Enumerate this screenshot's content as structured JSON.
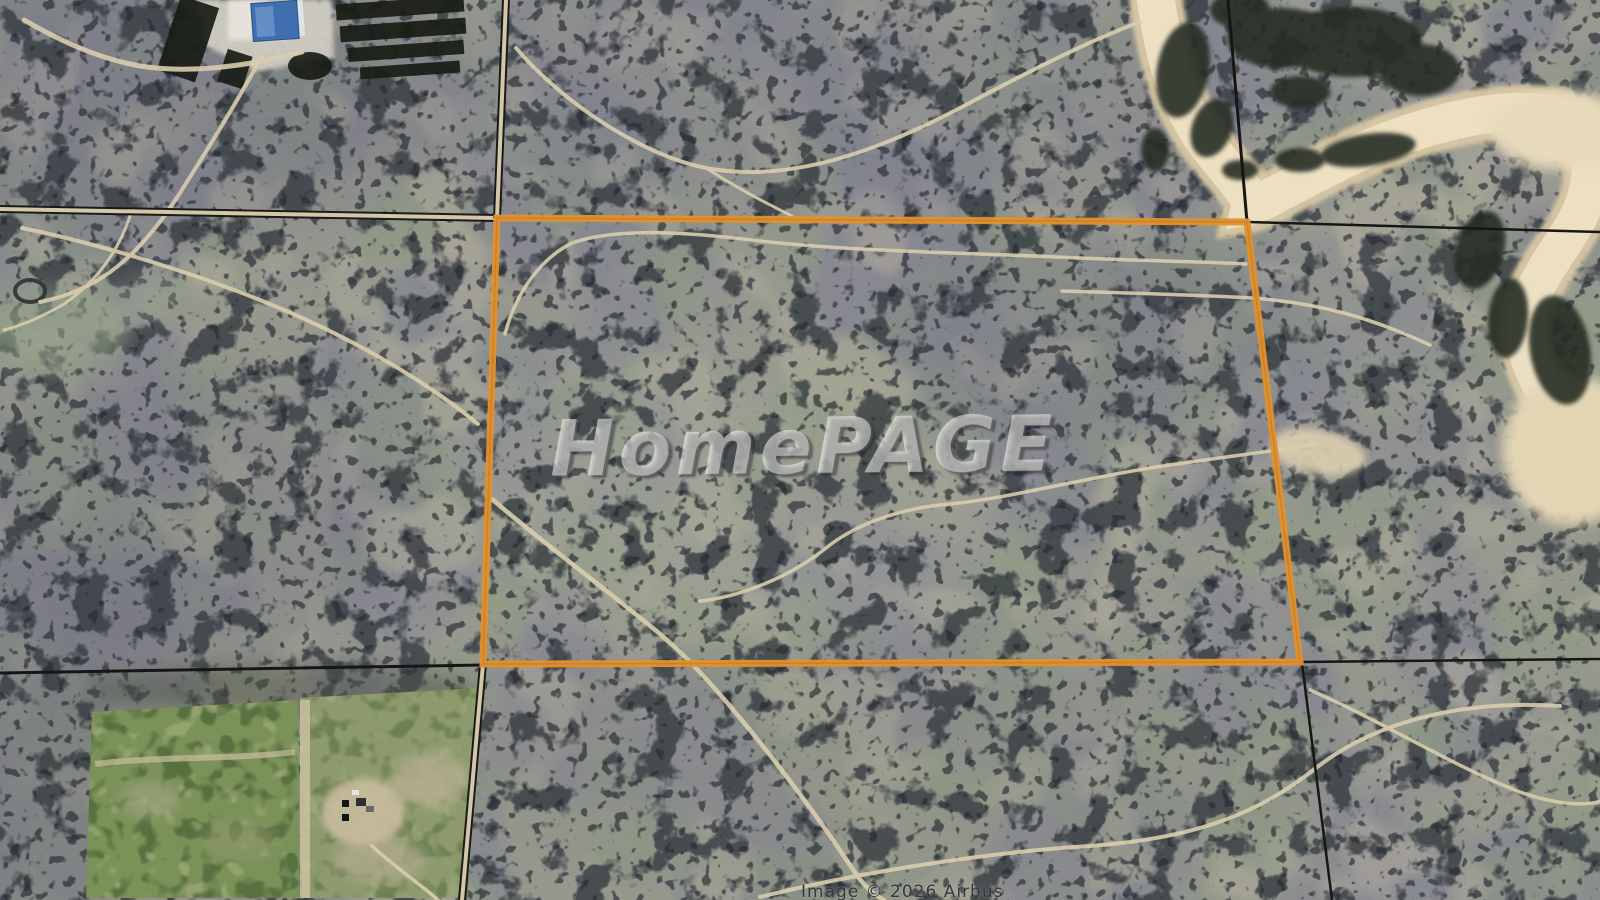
{
  "map": {
    "kind": "satellite-aerial-photo",
    "colors": {
      "parcel_boundary": "#e0912e",
      "section_line": "#161616",
      "river_sand": "#ecdfc2",
      "trail_sand": "#d9cdad",
      "terrain_base": "#97998f"
    }
  },
  "watermark": {
    "text": "HomePAGE"
  },
  "attribution": {
    "text": "Image © 2026 Airbus"
  }
}
